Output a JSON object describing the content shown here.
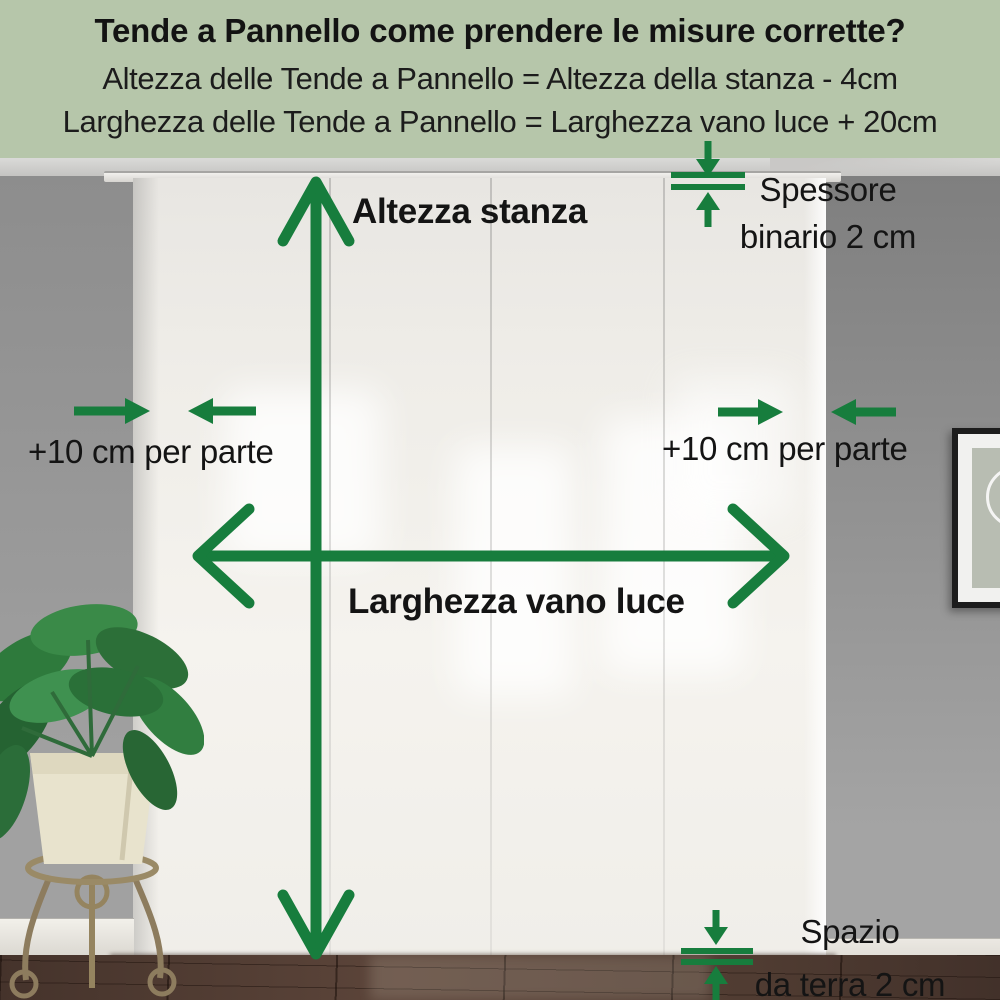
{
  "colors": {
    "accent_green": "#177d3d",
    "header_bg": "#b6c6aa",
    "text_black": "#141414",
    "wall_gray": "#9a9a9a",
    "curtain_white": "#f1efe9",
    "floor_brown": "#503c32"
  },
  "header": {
    "title": "Tende a Pannello come prendere le misure corrette?",
    "formula_height": "Altezza delle Tende a Pannello = Altezza della stanza - 4cm",
    "formula_width": "Larghezza delle Tende a Pannello = Larghezza vano luce + 20cm"
  },
  "measurements": {
    "room_height": {
      "label": "Altezza stanza"
    },
    "window_width": {
      "label": "Larghezza vano luce"
    },
    "side_allowance_left": {
      "label": "+10 cm per parte"
    },
    "side_allowance_right": {
      "label": "+10 cm per parte"
    },
    "rail_thickness": {
      "line1": "Spessore",
      "line2": "binario 2 cm"
    },
    "floor_clearance": {
      "line1": "Spazio",
      "line2": "da terra 2 cm"
    }
  },
  "scene": {
    "panel_count": 4,
    "objects": [
      "panel-curtains",
      "curtain-rail",
      "plant-on-stand",
      "picture-frame",
      "wood-floor"
    ]
  }
}
